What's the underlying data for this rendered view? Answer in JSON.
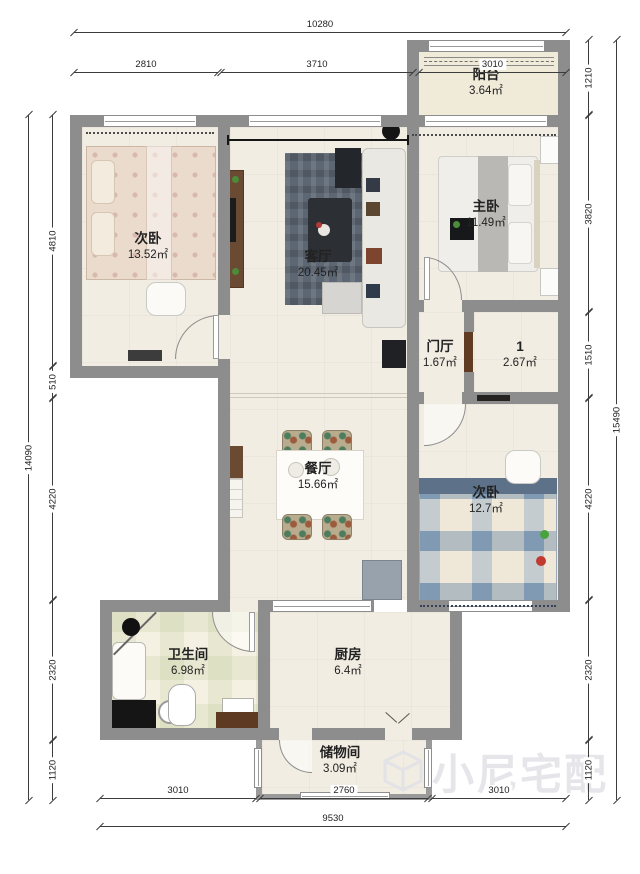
{
  "rooms": {
    "bedroom1": {
      "name": "次卧",
      "area": "13.52㎡"
    },
    "living": {
      "name": "客厅",
      "area": "20.45㎡"
    },
    "master": {
      "name": "主卧",
      "area": "11.49㎡"
    },
    "balcony": {
      "name": "阳台",
      "area": "3.64㎡"
    },
    "foyer": {
      "name": "门厅",
      "area": "1.67㎡"
    },
    "room1": {
      "name": "1",
      "area": "2.67㎡"
    },
    "dining": {
      "name": "餐厅",
      "area": "15.66㎡"
    },
    "bedroom2": {
      "name": "次卧",
      "area": "12.7㎡"
    },
    "bathroom": {
      "name": "卫生间",
      "area": "6.98㎡"
    },
    "kitchen": {
      "name": "厨房",
      "area": "6.4㎡"
    },
    "storage": {
      "name": "储物间",
      "area": "3.09㎡"
    }
  },
  "dimensions": {
    "top": {
      "total": "10280",
      "segments": [
        "2810",
        "3710",
        "3010"
      ]
    },
    "bottom": {
      "total": "9530",
      "segments": [
        "3010",
        "2760",
        "3010"
      ]
    },
    "left": {
      "total": "14090",
      "segments": [
        "4810",
        "510",
        "4220",
        "2320",
        "1120"
      ]
    },
    "right": {
      "total": "15490",
      "segments": [
        "1210",
        "3820",
        "1510",
        "4220",
        "2320",
        "1120"
      ]
    }
  },
  "watermark": {
    "text": "小尼宅配"
  },
  "colors": {
    "wall": "#8d8d8d",
    "floor": "#f2ede3",
    "wood": "#6b4a33",
    "rug": "#5d6774",
    "bed2_plaid": "#8ea6bd",
    "watermark": "#e1e1e7"
  }
}
